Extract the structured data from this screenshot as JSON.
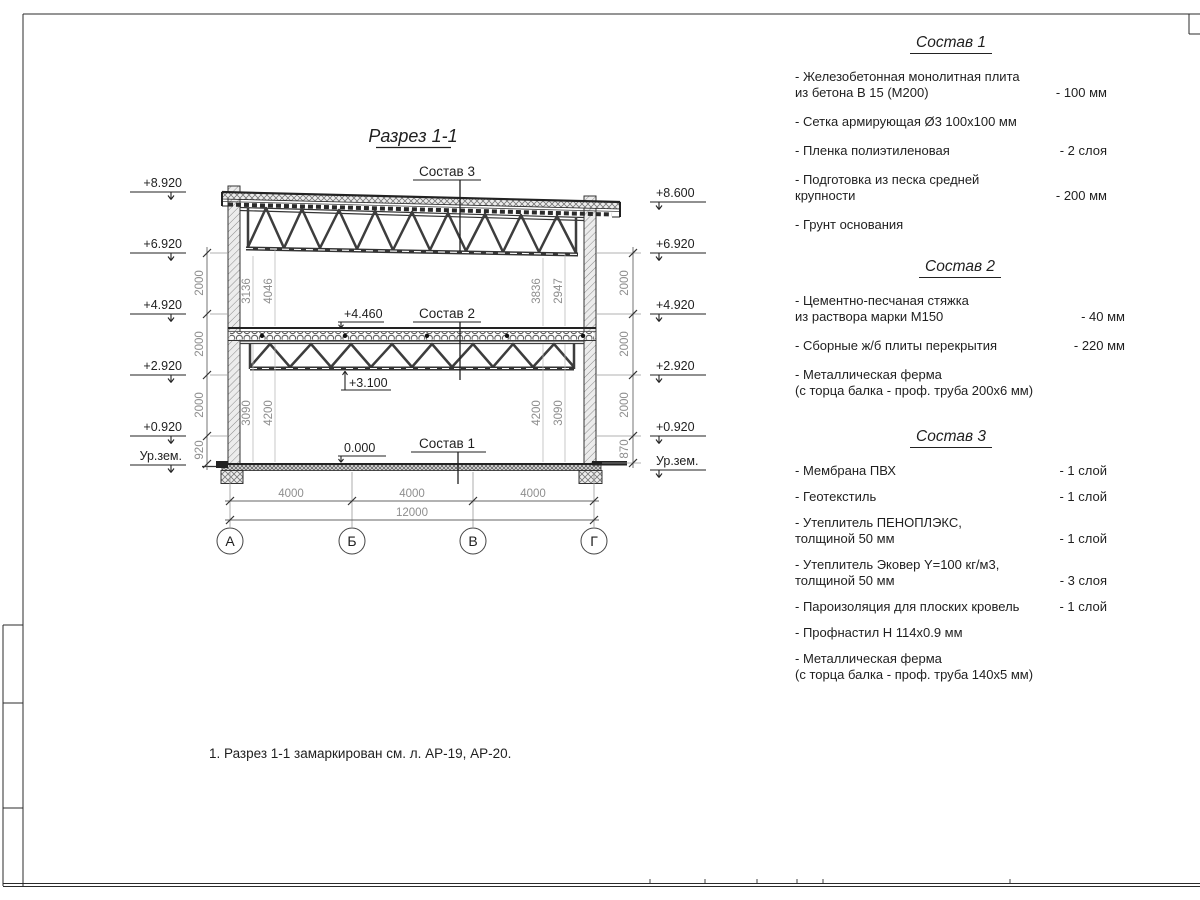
{
  "section": {
    "title": "Разрез 1-1",
    "callouts": [
      "Состав 3",
      "Состав 2",
      "Состав 1"
    ],
    "elev_left": [
      "+8.920",
      "+6.920",
      "+4.920",
      "+2.920",
      "+0.920",
      "Ур.зем."
    ],
    "elev_right": [
      "+8.600",
      "+6.920",
      "+4.920",
      "+2.920",
      "+0.920",
      "Ур.зем."
    ],
    "elev_inline": [
      "+4.460",
      "+3.100",
      "0.000"
    ],
    "chain_left": [
      "2000",
      "2000",
      "2000",
      "920"
    ],
    "chain_right": [
      "2000",
      "2000",
      "2000",
      "870"
    ],
    "inner_top": [
      "3136",
      "4046",
      "3836",
      "2947"
    ],
    "inner_bottom": [
      "3090",
      "4200",
      "4200",
      "3090"
    ],
    "span_dims": [
      "4000",
      "4000",
      "4000"
    ],
    "total_dim": "12000",
    "axes": [
      "А",
      "Б",
      "В",
      "Г"
    ]
  },
  "compositions": [
    {
      "title": "Состав 1",
      "items": [
        {
          "label": "- Железобетонная  монолитная плита\nиз бетона В 15 (М200)",
          "value": "- 100 мм"
        },
        {
          "label": "- Сетка армирующая Ø3 100х100 мм",
          "value": ""
        },
        {
          "label": "- Пленка полиэтиленовая",
          "value": "- 2 слоя"
        },
        {
          "label": "- Подготовка из песка средней\nкрупности",
          "value": "- 200 мм"
        },
        {
          "label": "- Грунт основания",
          "value": ""
        }
      ]
    },
    {
      "title": "Состав 2",
      "items": [
        {
          "label": "- Цементно-песчаная стяжка\nиз раствора марки М150",
          "value": "- 40 мм"
        },
        {
          "label": "- Сборные ж/б плиты перекрытия",
          "value": "- 220 мм"
        },
        {
          "label": "- Металлическая ферма\n(с торца балка - проф. труба 200х6 мм)",
          "value": ""
        }
      ]
    },
    {
      "title": "Состав 3",
      "items": [
        {
          "label": "- Мембрана ПВХ",
          "value": "- 1 слой"
        },
        {
          "label": "- Геотекстиль",
          "value": "- 1 слой"
        },
        {
          "label": "- Утеплитель ПЕНОПЛЭКС,\nтолщиной 50 мм",
          "value": "- 1 слой"
        },
        {
          "label": "- Утеплитель Эковер Y=100 кг/м3,\nтолщиной 50 мм",
          "value": "- 3 слоя"
        },
        {
          "label": "- Пароизоляция для плоских кровель",
          "value": "- 1 слой"
        },
        {
          "label": "- Профнастил Н 114х0.9 мм",
          "value": ""
        },
        {
          "label": "- Металлическая ферма\n(с торца балка - проф. труба 140х5 мм)",
          "value": ""
        }
      ]
    }
  ],
  "note": "1. Разрез 1-1 замаркирован см. л. АР-19, АР-20."
}
